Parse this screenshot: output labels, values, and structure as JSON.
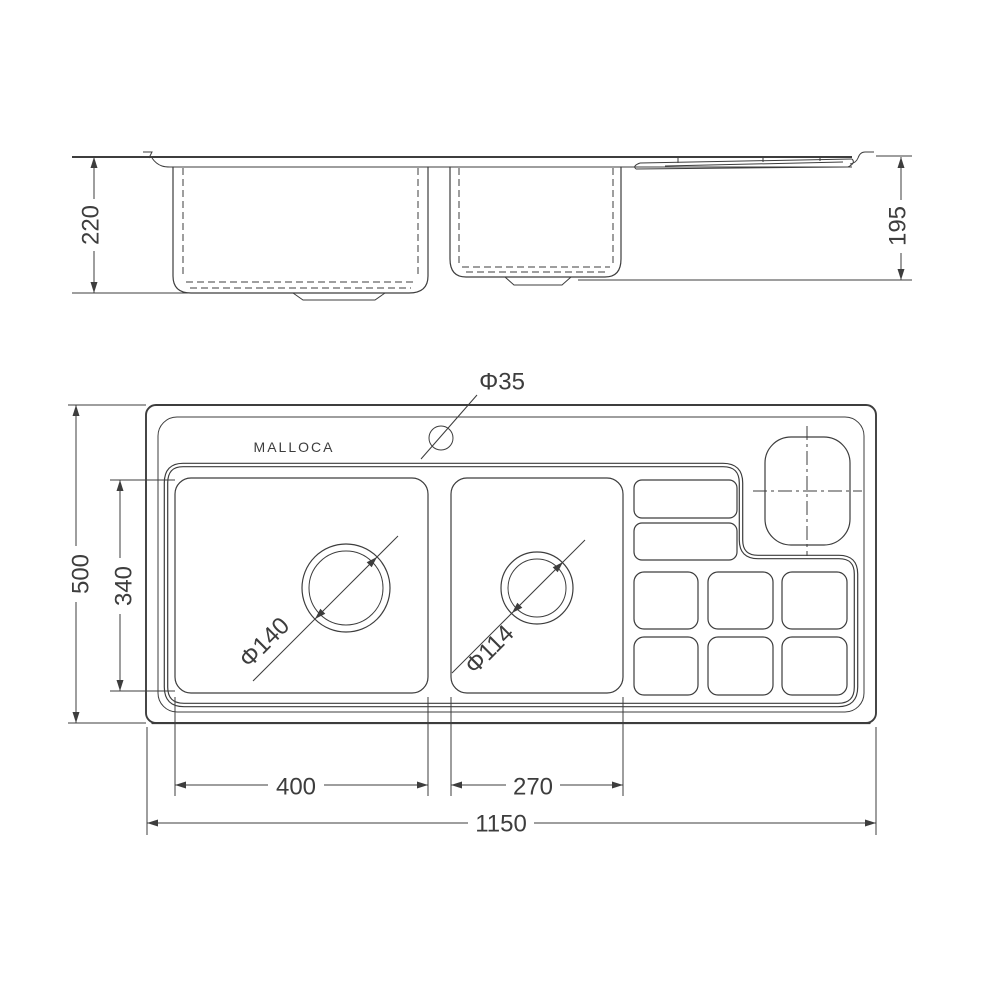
{
  "colors": {
    "line": "#3d3d3d",
    "background": "#ffffff"
  },
  "drawing": {
    "brand": "MALLOCA",
    "front_view": {
      "dim_left_bowl_depth": "220",
      "dim_right_bowl_depth": "195"
    },
    "plan_view": {
      "dim_overall_length": "1150",
      "dim_overall_width": "500",
      "dim_bowl_inner_width": "340",
      "dim_left_bowl_length": "400",
      "dim_right_bowl_length": "270",
      "label_faucet_hole": "Φ35",
      "label_left_drain": "Φ140",
      "label_right_drain": "Φ114"
    }
  }
}
